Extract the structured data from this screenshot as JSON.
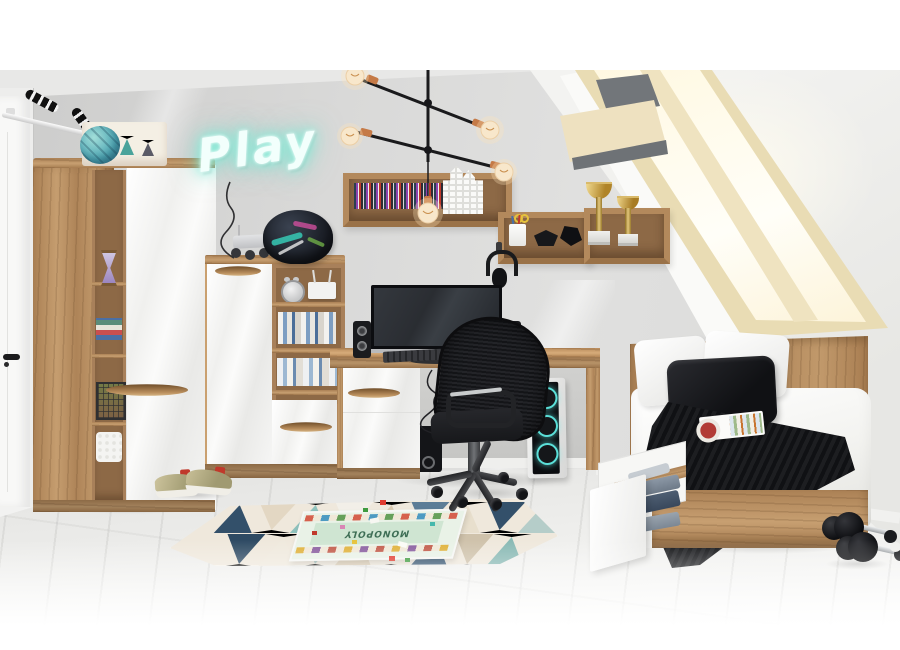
{
  "meta": {
    "scene_type": "furniture showroom photograph",
    "room": "teen attic bedroom with oak and white gloss furniture set"
  },
  "texts": {
    "neon_sign": "Play",
    "board_game_title": "MONOPOLY"
  },
  "colors": {
    "wall": "#d8d8d7",
    "ceiling": "#e9e9e8",
    "slanted_ceiling": "#f0f0ee",
    "floor": "#ececea",
    "oak_wood": "#b4895b",
    "white_gloss": "#f6f6f5",
    "neon_glow": "#8ff0dd",
    "chandelier_copper": "#c47a47",
    "pc_led_ring": "#5fe3dc",
    "trophy_gold": "#d4af5e",
    "rug_navy": "#33506a",
    "rug_teal": "#8fc2bd",
    "rug_beige": "#e0d2bc",
    "textile_black": "#17181a",
    "bedding_white": "#fbfbfa",
    "skylight_frame": "#e9dcb4"
  },
  "objects": [
    "white interior door with black handle",
    "wall-mounted pull-up bar with striped grips",
    "corner wardrobe with oak frame and white gloss doors",
    "open shelf column with hourglass, books, wire basket and crochet basket",
    "turquoise decorative ball",
    "patterned storage box",
    "neon Play sign with hanging cable",
    "black sputnik chandelier with copper sockets and filament bulbs",
    "oak wall shelf with CD collection and white house lantern",
    "oak wall shelf with pencil cup, scissors and black geometric ornaments",
    "two gold trophies on marble bases",
    "roof skylight window with wooden frame",
    "graffiti motorbike helmet",
    "lunar rover toy",
    "silver alarm clock",
    "wi-fi router",
    "rows of books",
    "oak desk with white drawer cabinet",
    "widescreen monitor",
    "black keyboard and mouse",
    "stereo speaker pair",
    "subwoofer",
    "black mesh office chair",
    "gaming PC tower with cyan LED fan rings",
    "black headphones on wall hook",
    "single oak bed",
    "white pillows and black cushion",
    "white duvet",
    "black knitted throw",
    "open magazine",
    "open under-bed storage drawer with folded clothes",
    "pair of black dumbbells",
    "geometric triangle rug",
    "Monopoly board game with scattered pieces",
    "pair of olive sneakers"
  ]
}
